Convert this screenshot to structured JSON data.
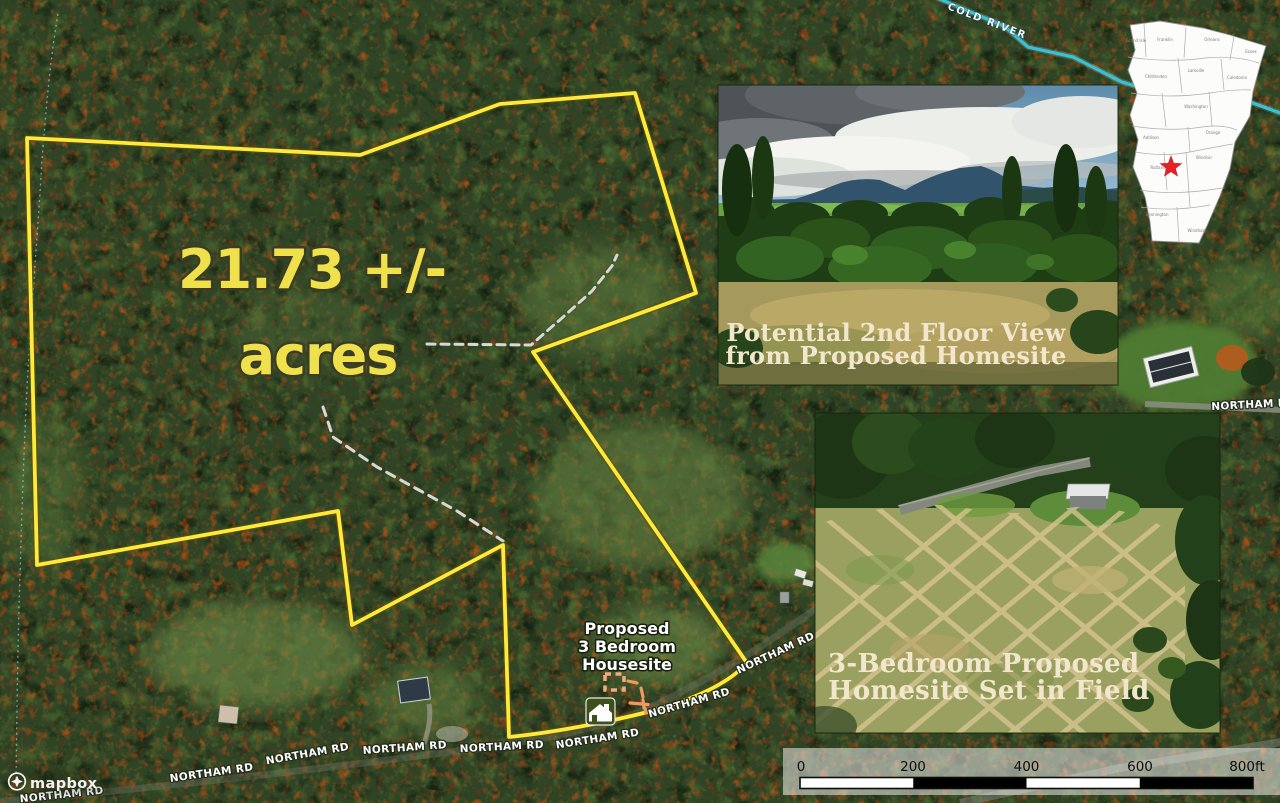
{
  "map": {
    "acreage": {
      "line1": "21.73 +/-",
      "line2": "acres",
      "color": "#efe14c"
    },
    "housesite": {
      "line1": "Proposed",
      "line2": "3 Bedroom",
      "line3": "Housesite"
    },
    "river_label": "COLD RIVER",
    "boundary_color": "#ffe93d",
    "river_color": "#33c3da",
    "road_labels": [
      {
        "text": "NORTHAM RD",
        "x": 62,
        "y": 798,
        "rot": -6
      },
      {
        "text": "NORTHAM RD",
        "x": 212,
        "y": 776,
        "rot": -8
      },
      {
        "text": "NORTHAM RD",
        "x": 308,
        "y": 757,
        "rot": -10
      },
      {
        "text": "NORTHAM RD",
        "x": 405,
        "y": 751,
        "rot": -4
      },
      {
        "text": "NORTHAM RD",
        "x": 502,
        "y": 750,
        "rot": -3
      },
      {
        "text": "NORTHAM RD",
        "x": 598,
        "y": 742,
        "rot": -9
      },
      {
        "text": "NORTHAM RD",
        "x": 690,
        "y": 706,
        "rot": -16
      },
      {
        "text": "NORTHAM RD",
        "x": 777,
        "y": 656,
        "rot": -25
      },
      {
        "text": "NORTHAM R",
        "x": 1249,
        "y": 408,
        "rot": -3
      }
    ]
  },
  "insets": {
    "view_photo": {
      "caption": [
        "Potential 2nd Floor View",
        "from Proposed Homesite"
      ]
    },
    "homesite_photo": {
      "caption": [
        "3-Bedroom Proposed",
        "Homesite Set in Field"
      ]
    },
    "vermont_map": {
      "marker": "red-star",
      "marker_color": "#e82127",
      "counties": [
        "Grand Isle",
        "Franklin",
        "Orleans",
        "Essex",
        "Chittenden",
        "Lamoille",
        "Caledonia",
        "Washington",
        "Addison",
        "Orange",
        "Rutland",
        "Windsor",
        "Bennington",
        "Windham"
      ]
    }
  },
  "scale_bar": {
    "tick_labels": [
      "0",
      "200",
      "400",
      "600"
    ],
    "end_label": "800ft"
  },
  "attribution": {
    "brand": "mapbox"
  }
}
